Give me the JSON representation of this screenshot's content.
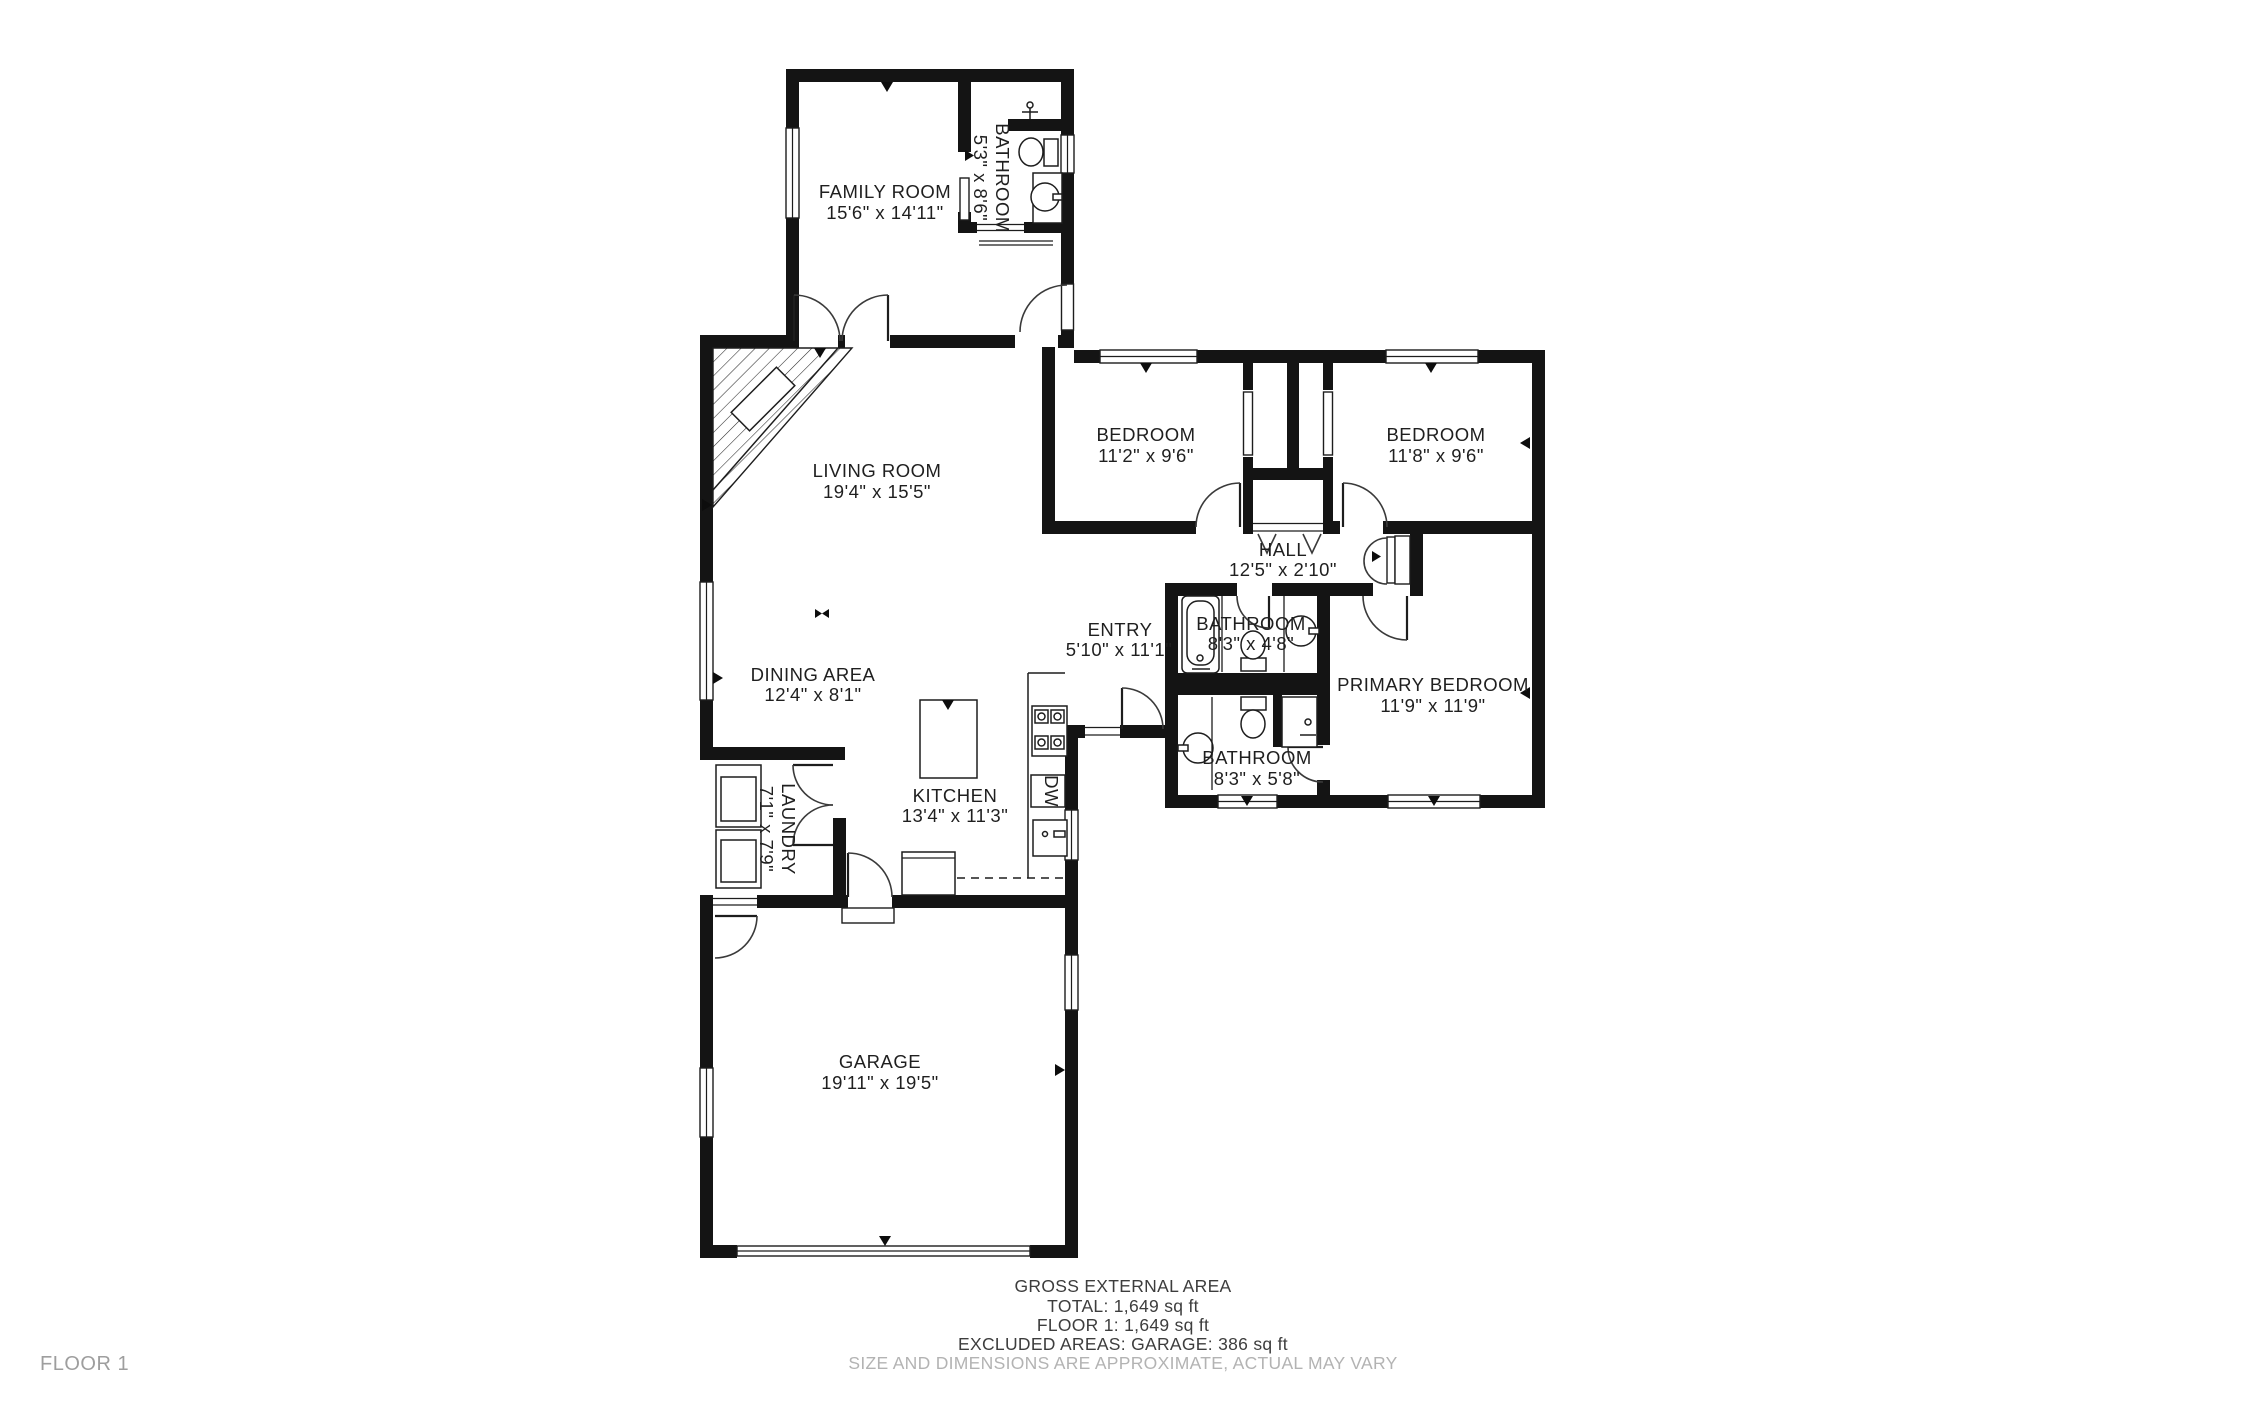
{
  "floorplan": {
    "title": "FLOOR 1",
    "rooms": [
      {
        "id": "family-room",
        "name": "FAMILY ROOM",
        "dims": "15'6\" x 14'11\""
      },
      {
        "id": "bathroom-top",
        "name": "BATHROOM",
        "dims": "5'3\" x 8'6\""
      },
      {
        "id": "living-room",
        "name": "LIVING ROOM",
        "dims": "19'4\" x 15'5\""
      },
      {
        "id": "bedroom-left",
        "name": "BEDROOM",
        "dims": "11'2\" x 9'6\""
      },
      {
        "id": "bedroom-right",
        "name": "BEDROOM",
        "dims": "11'8\" x 9'6\""
      },
      {
        "id": "hall",
        "name": "HALL",
        "dims": "12'5\" x 2'10\""
      },
      {
        "id": "entry",
        "name": "ENTRY",
        "dims": "5'10\" x 11'1\""
      },
      {
        "id": "bathroom-hall",
        "name": "BATHROOM",
        "dims": "8'3\" x 4'8\""
      },
      {
        "id": "primary-bedroom",
        "name": "PRIMARY BEDROOM",
        "dims": "11'9\" x 11'9\""
      },
      {
        "id": "bathroom-primary",
        "name": "BATHROOM",
        "dims": "8'3\" x 5'8\""
      },
      {
        "id": "dining-area",
        "name": "DINING AREA",
        "dims": "12'4\" x 8'1\""
      },
      {
        "id": "kitchen",
        "name": "KITCHEN",
        "dims": "13'4\" x 11'3\""
      },
      {
        "id": "laundry",
        "name": "LAUNDRY",
        "dims": "7'1\" x 7'9\""
      },
      {
        "id": "garage",
        "name": "GARAGE",
        "dims": "19'11\" x 19'5\""
      }
    ],
    "appliance_labels": {
      "dishwasher": "DW"
    },
    "footer": {
      "line1": "GROSS EXTERNAL AREA",
      "line2": "TOTAL: 1,649 sq ft",
      "line3": "FLOOR 1: 1,649 sq ft",
      "line4": "EXCLUDED AREAS: GARAGE: 386 sq ft",
      "disclaimer": "SIZE AND DIMENSIONS ARE APPROXIMATE, ACTUAL MAY VARY"
    },
    "colors": {
      "wall": "#141414",
      "text": "#1f1f1f",
      "muted": "#b3b3b3",
      "footer": "#3d3d3d",
      "background": "#ffffff"
    }
  }
}
